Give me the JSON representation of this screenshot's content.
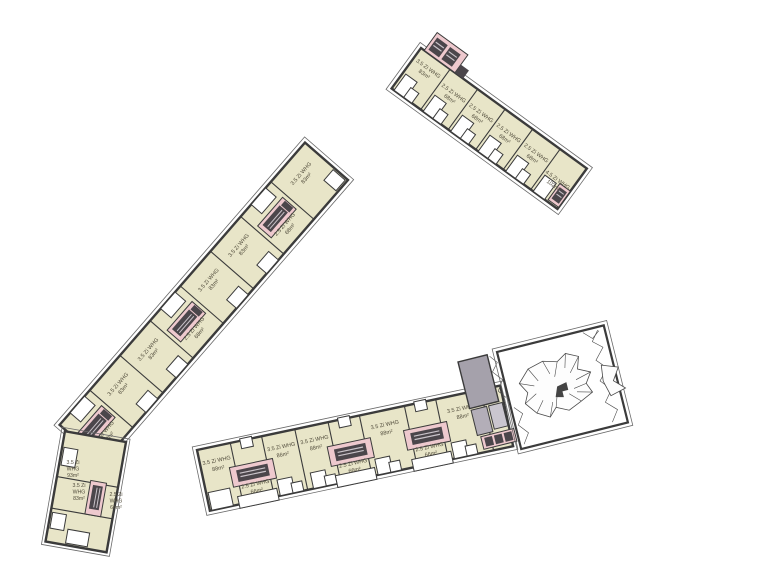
{
  "plan": {
    "type": "architectural-floor-plan",
    "buildings": {
      "north": {
        "units": [
          {
            "type": "3.5 Zi WHG",
            "area": "83m²"
          },
          {
            "type": "2.5 Zi WHG",
            "area": "68m²"
          },
          {
            "type": "2.5 Zi WHG",
            "area": "68m²"
          },
          {
            "type": "2.5 Zi WHG",
            "area": "68m²"
          },
          {
            "type": "2.5 Zi WHG",
            "area": "68m²"
          },
          {
            "type": "4.5 Zi WHG",
            "area": "102m²"
          }
        ]
      },
      "west": {
        "units": [
          {
            "type": "3.5 Zi WHG",
            "area": "83m²"
          },
          {
            "type": "2.5 Zi WHG",
            "area": "68m²"
          },
          {
            "type": "3.5 Zi WHG",
            "area": "83m²"
          },
          {
            "type": "3.5 Zi WHG",
            "area": "83m²"
          },
          {
            "type": "2.5 Zi WHG",
            "area": "68m²"
          },
          {
            "type": "3.5 Zi WHG",
            "area": "83m²"
          },
          {
            "type": "3.5 Zi WHG",
            "area": "83m²"
          },
          {
            "type": "2.5 Zi WHG",
            "area": "68m²"
          }
        ],
        "corner_units": [
          {
            "rooms": "3.5 Zi",
            "label": "WHG",
            "area": "93m²"
          },
          {
            "rooms": "3.5 Zi",
            "label": "WHG",
            "area": "83m²"
          },
          {
            "rooms": "2.5 Zi",
            "label": "WHG",
            "area": "66m²"
          }
        ]
      },
      "south": {
        "units": [
          {
            "type": "3.5 Zi WHG",
            "area": "88m²"
          },
          {
            "type": "2.5 Zi WHG",
            "area": "66m²"
          },
          {
            "type": "3.5 Zi WHG",
            "area": "86m²"
          },
          {
            "type": "3.5 Zi WHG",
            "area": "88m²"
          },
          {
            "type": "2.5 Zi WHG",
            "area": "66m²"
          },
          {
            "type": "3.5 Zi WHG",
            "area": "88m²"
          },
          {
            "type": "2.5 Zi WHG",
            "area": "66m²"
          },
          {
            "type": "3.5 Zi WHG",
            "area": "88m²"
          }
        ]
      }
    },
    "colors": {
      "apartment_fill": "#e8e5c8",
      "stairwell_pink": "#eec9ce",
      "tread_dark": "#4b464b",
      "core_gray": "#a5a1ab",
      "wall": "#3b3b3b",
      "label_text": "#4f4a3a",
      "background": "#ffffff"
    }
  }
}
